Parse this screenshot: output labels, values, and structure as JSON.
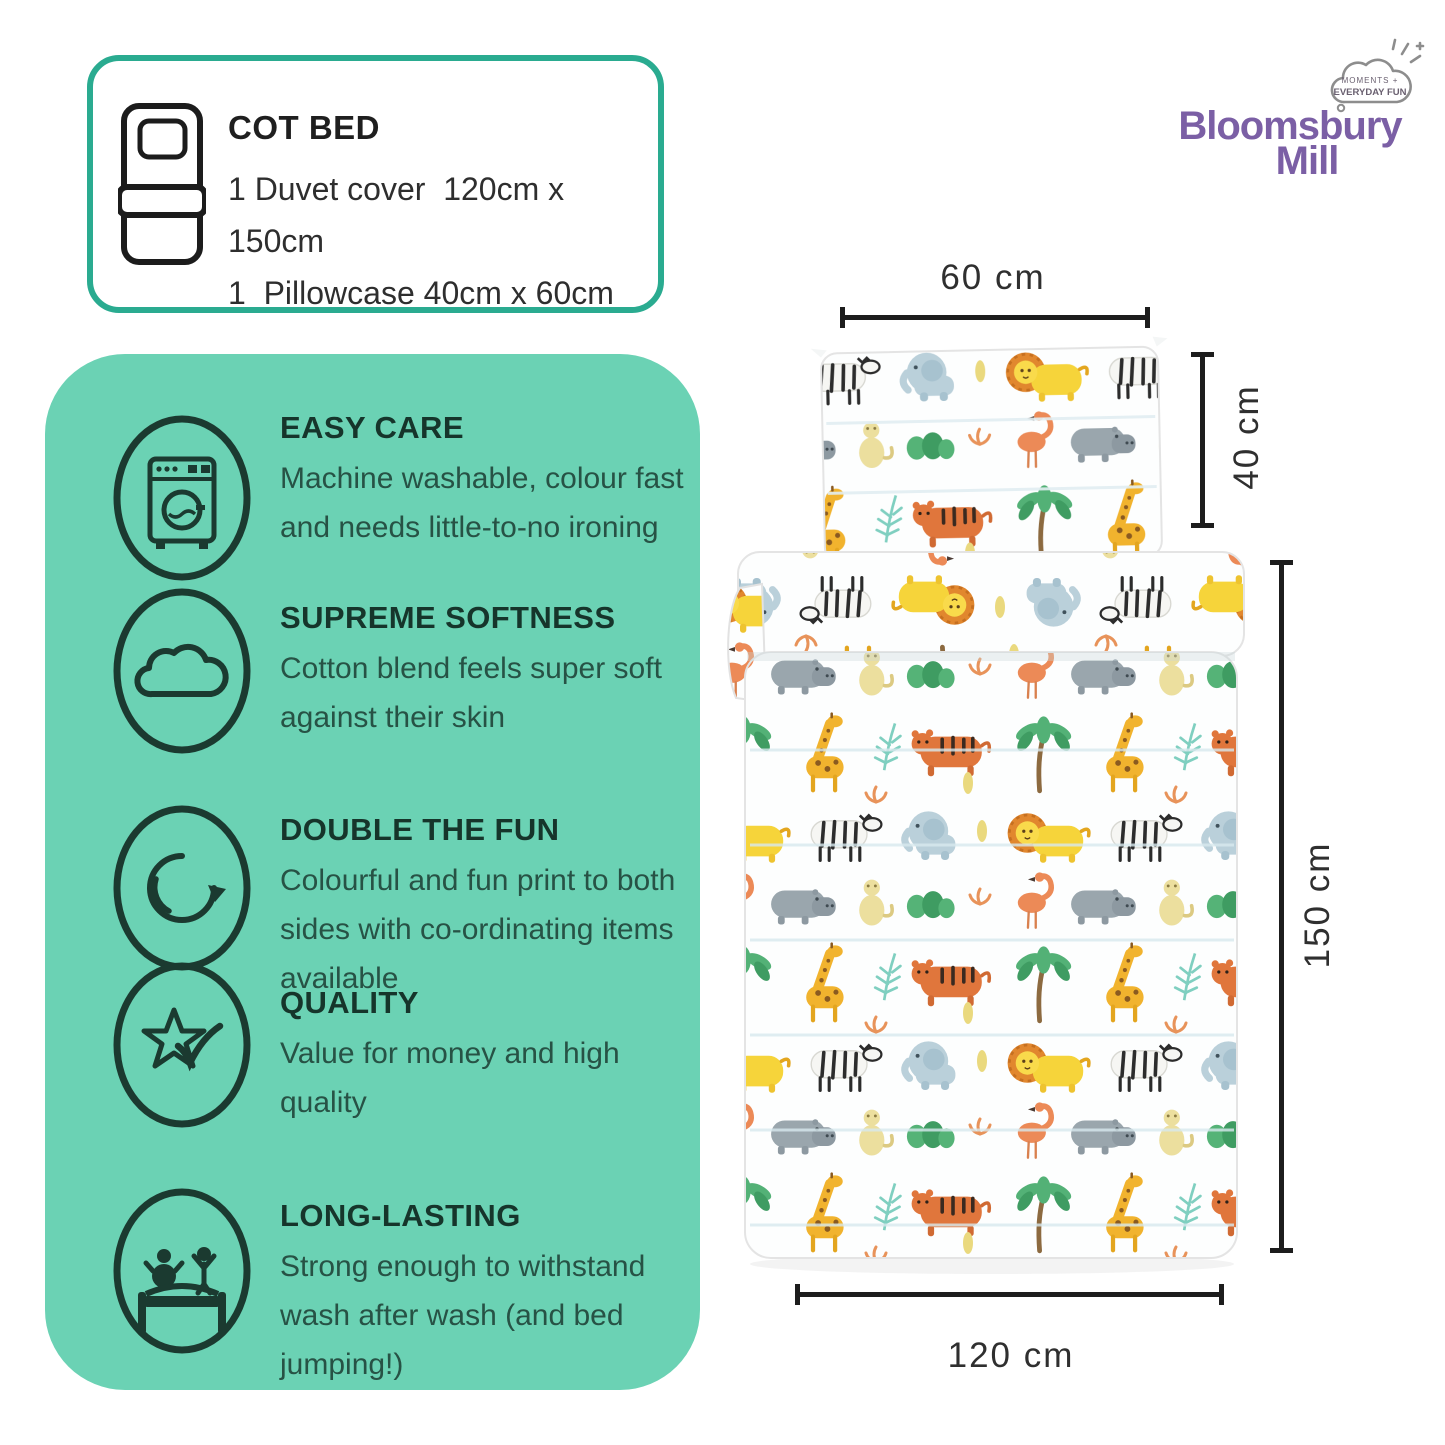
{
  "colors": {
    "panel_green": "#6bd2b4",
    "box_teal": "#2aab90",
    "brand_purple": "#7b5fa5",
    "ink_dark": "#16352b",
    "ink_body": "#275245",
    "dim_line": "#1d1d1d",
    "dim_text": "#2f2f2f"
  },
  "spec_box": {
    "icon": "cot-bed-icon",
    "title": "COT BED",
    "lines": [
      "1 Duvet cover  120cm x 150cm",
      "1  Pillowcase 40cm x 60cm"
    ]
  },
  "brand": {
    "name_line1": "Bloomsbury",
    "name_line2": "Mill",
    "badge_line1": "MOMENTS +",
    "badge_line2": "EVERYDAY FUN"
  },
  "features": [
    {
      "icon": "washing-machine-icon",
      "title": "EASY CARE",
      "description": "Machine washable, colour fast and needs little-to-no ironing"
    },
    {
      "icon": "cloud-icon",
      "title": "SUPREME SOFTNESS",
      "description": "Cotton blend feels super soft against their skin"
    },
    {
      "icon": "rotating-arrow-icon",
      "title": "DOUBLE THE FUN",
      "description": "Colourful and fun print to both sides with co-ordinating items available"
    },
    {
      "icon": "star-check-icon",
      "title": "QUALITY",
      "description": "Value for money and high quality"
    },
    {
      "icon": "bed-jumping-icon",
      "title": "LONG-LASTING",
      "description": "Strong enough to withstand wash after wash (and bed jumping!)"
    }
  ],
  "dimensions": {
    "pillow_width": "60 cm",
    "pillow_height": "40 cm",
    "duvet_height": "150 cm",
    "duvet_width": "120 cm"
  }
}
